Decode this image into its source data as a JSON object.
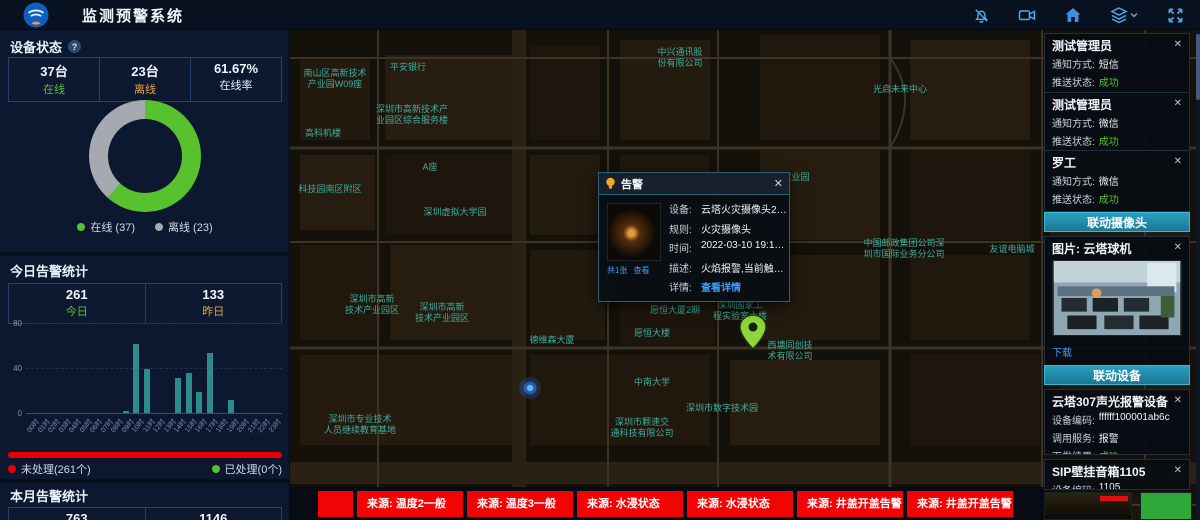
{
  "header": {
    "title": "监测预警系统",
    "icons": [
      "alarm-mute",
      "video-camera",
      "home",
      "layers",
      "fullscreen"
    ]
  },
  "icons": {
    "close": "✕",
    "help": "?",
    "chevron_down": "⌄"
  },
  "device_status": {
    "title": "设备状态",
    "stats": [
      {
        "value": "37台",
        "label": "在线",
        "color": "#57c22d"
      },
      {
        "value": "23台",
        "label": "离线",
        "color": "#e8a33d"
      },
      {
        "value": "61.67%",
        "label": "在线率",
        "color": "#e8eef7"
      }
    ],
    "legend": [
      {
        "label": "在线 (37)",
        "color": "#57c22d"
      },
      {
        "label": "离线 (23)",
        "color": "#a6aab0"
      }
    ]
  },
  "today_alarms": {
    "title": "今日告警统计",
    "stats": [
      {
        "value": "261",
        "label": "今日",
        "color": "#57c22d"
      },
      {
        "value": "133",
        "label": "昨日",
        "color": "#e8a33d"
      }
    ]
  },
  "process_status": {
    "unhandled": {
      "label": "未处理(261个)",
      "color": "#e80000"
    },
    "handled": {
      "label": "已处理(0个)",
      "color": "#57c22d"
    }
  },
  "month_alarms": {
    "title": "本月告警统计",
    "values": [
      "763",
      "1146"
    ]
  },
  "chart_data": [
    {
      "type": "pie",
      "title": "设备状态",
      "labels": [
        "在线",
        "离线"
      ],
      "values": [
        37,
        23
      ],
      "colors": [
        "#57c22d",
        "#a6aab0"
      ],
      "donut": true,
      "online_rate": "61.67%",
      "legend_position": "bottom"
    },
    {
      "type": "bar",
      "title": "今日告警统计(按小时)",
      "categories": [
        "00时",
        "01时",
        "02时",
        "03时",
        "04时",
        "05时",
        "06时",
        "07时",
        "08时",
        "09时",
        "10时",
        "11时",
        "12时",
        "13时",
        "14时",
        "15时",
        "16时",
        "17时",
        "18时",
        "19时",
        "20时",
        "21时",
        "22时",
        "23时"
      ],
      "values": [
        0,
        0,
        0,
        0,
        0,
        0,
        0,
        0,
        0,
        2,
        61,
        39,
        0,
        0,
        31,
        36,
        19,
        53,
        0,
        12,
        0,
        0,
        0,
        0
      ],
      "xlabel": "小时",
      "ylabel": "",
      "ylim": [
        0,
        80
      ],
      "yticks": [
        0,
        40,
        80
      ],
      "bar_color": "#2e8b8b",
      "grid": "dashed"
    }
  ],
  "map": {
    "popup": {
      "title": "告警",
      "fields": [
        {
          "label": "设备:",
          "value": "云塔火灾摄像头202",
          "link": false
        },
        {
          "label": "规则:",
          "value": "火灾摄像头",
          "link": false
        },
        {
          "label": "时间:",
          "value": "2022-03-10 19:13:07",
          "link": false
        },
        {
          "label": "描述:",
          "value": "火焰报警,当前触发值为...",
          "link": false
        },
        {
          "label": "详情:",
          "value": "查看详情",
          "link": true
        }
      ],
      "image_links": [
        "共1张",
        "查看"
      ]
    },
    "labels": [
      {
        "x": 45,
        "y": 46,
        "lines": [
          "南山区高新技术",
          "产业园W09座"
        ]
      },
      {
        "x": 118,
        "y": 40,
        "lines": [
          "平安银行"
        ]
      },
      {
        "x": 122,
        "y": 82,
        "lines": [
          "深圳市高新技术产",
          "业园区综合服务楼"
        ]
      },
      {
        "x": 33,
        "y": 106,
        "lines": [
          "高科机楼"
        ]
      },
      {
        "x": 140,
        "y": 140,
        "lines": [
          "A座"
        ]
      },
      {
        "x": 390,
        "y": 25,
        "lines": [
          "中兴通讯股",
          "份有限公司"
        ]
      },
      {
        "x": 610,
        "y": 62,
        "lines": [
          "光启未来中心"
        ]
      },
      {
        "x": 497,
        "y": 150,
        "lines": [
          "中兴工业园"
        ]
      },
      {
        "x": 165,
        "y": 185,
        "lines": [
          "深圳虚拟大学园"
        ]
      },
      {
        "x": 40,
        "y": 162,
        "lines": [
          "科技园南区附区"
        ]
      },
      {
        "x": 82,
        "y": 272,
        "lines": [
          "深圳市高新",
          "技术产业园区"
        ]
      },
      {
        "x": 152,
        "y": 280,
        "lines": [
          "深圳市高新",
          "技术产业园区"
        ]
      },
      {
        "x": 70,
        "y": 392,
        "lines": [
          "深圳市专业技术",
          "人员继续教育基地"
        ]
      },
      {
        "x": 262,
        "y": 313,
        "lines": [
          "德维森大厦"
        ]
      },
      {
        "x": 385,
        "y": 283,
        "lines": [
          "愿恒大厦2期"
        ]
      },
      {
        "x": 362,
        "y": 306,
        "lines": [
          "愿恒大楼"
        ]
      },
      {
        "x": 362,
        "y": 355,
        "lines": [
          "中南大学"
        ]
      },
      {
        "x": 432,
        "y": 381,
        "lines": [
          "深圳市数字技术园"
        ]
      },
      {
        "x": 450,
        "y": 278,
        "lines": [
          "深圳国家工",
          "程实验室大楼"
        ]
      },
      {
        "x": 500,
        "y": 318,
        "lines": [
          "西塘同创技",
          "术有限公司"
        ]
      },
      {
        "x": 352,
        "y": 395,
        "lines": [
          "深圳市颗速交",
          "通科技有限公司"
        ]
      },
      {
        "x": 614,
        "y": 216,
        "lines": [
          "中国邮政集团公司深",
          "圳市国际业务分公司"
        ]
      },
      {
        "x": 722,
        "y": 222,
        "lines": [
          "友谊电脑城"
        ]
      }
    ]
  },
  "right_panel": {
    "notifications": {
      "method_label": "通知方式:",
      "status_label": "推送状态:",
      "cards": [
        {
          "title": "测试管理员",
          "method": "短信",
          "status": "成功"
        },
        {
          "title": "测试管理员",
          "method": "微信",
          "status": "成功"
        },
        {
          "title": "罗工",
          "method": "微信",
          "status": "成功"
        }
      ]
    },
    "camera_section": {
      "header": "联动摄像头",
      "card_title": "图片: 云塔球机",
      "download_label": "下载"
    },
    "device_section": {
      "header": "联动设备",
      "cards": [
        {
          "title": "云塔307声光报警设备",
          "rows": [
            {
              "label": "设备编码:",
              "value": "ffffff100001ab6c",
              "success": false
            },
            {
              "label": "调用服务:",
              "value": "报警",
              "success": false
            },
            {
              "label": "下发结果:",
              "value": "成功",
              "success": true
            }
          ]
        },
        {
          "title": "SIP壁挂音箱1105",
          "rows": [
            {
              "label": "设备编码:",
              "value": "1105",
              "success": false
            }
          ]
        }
      ]
    }
  },
  "ticker": {
    "items": [
      "",
      "来源: 温度2一般",
      "来源: 温度3一般",
      "来源: 水浸状态",
      "来源: 水浸状态",
      "来源: 井盖开盖告警",
      "来源: 井盖开盖告警"
    ]
  }
}
